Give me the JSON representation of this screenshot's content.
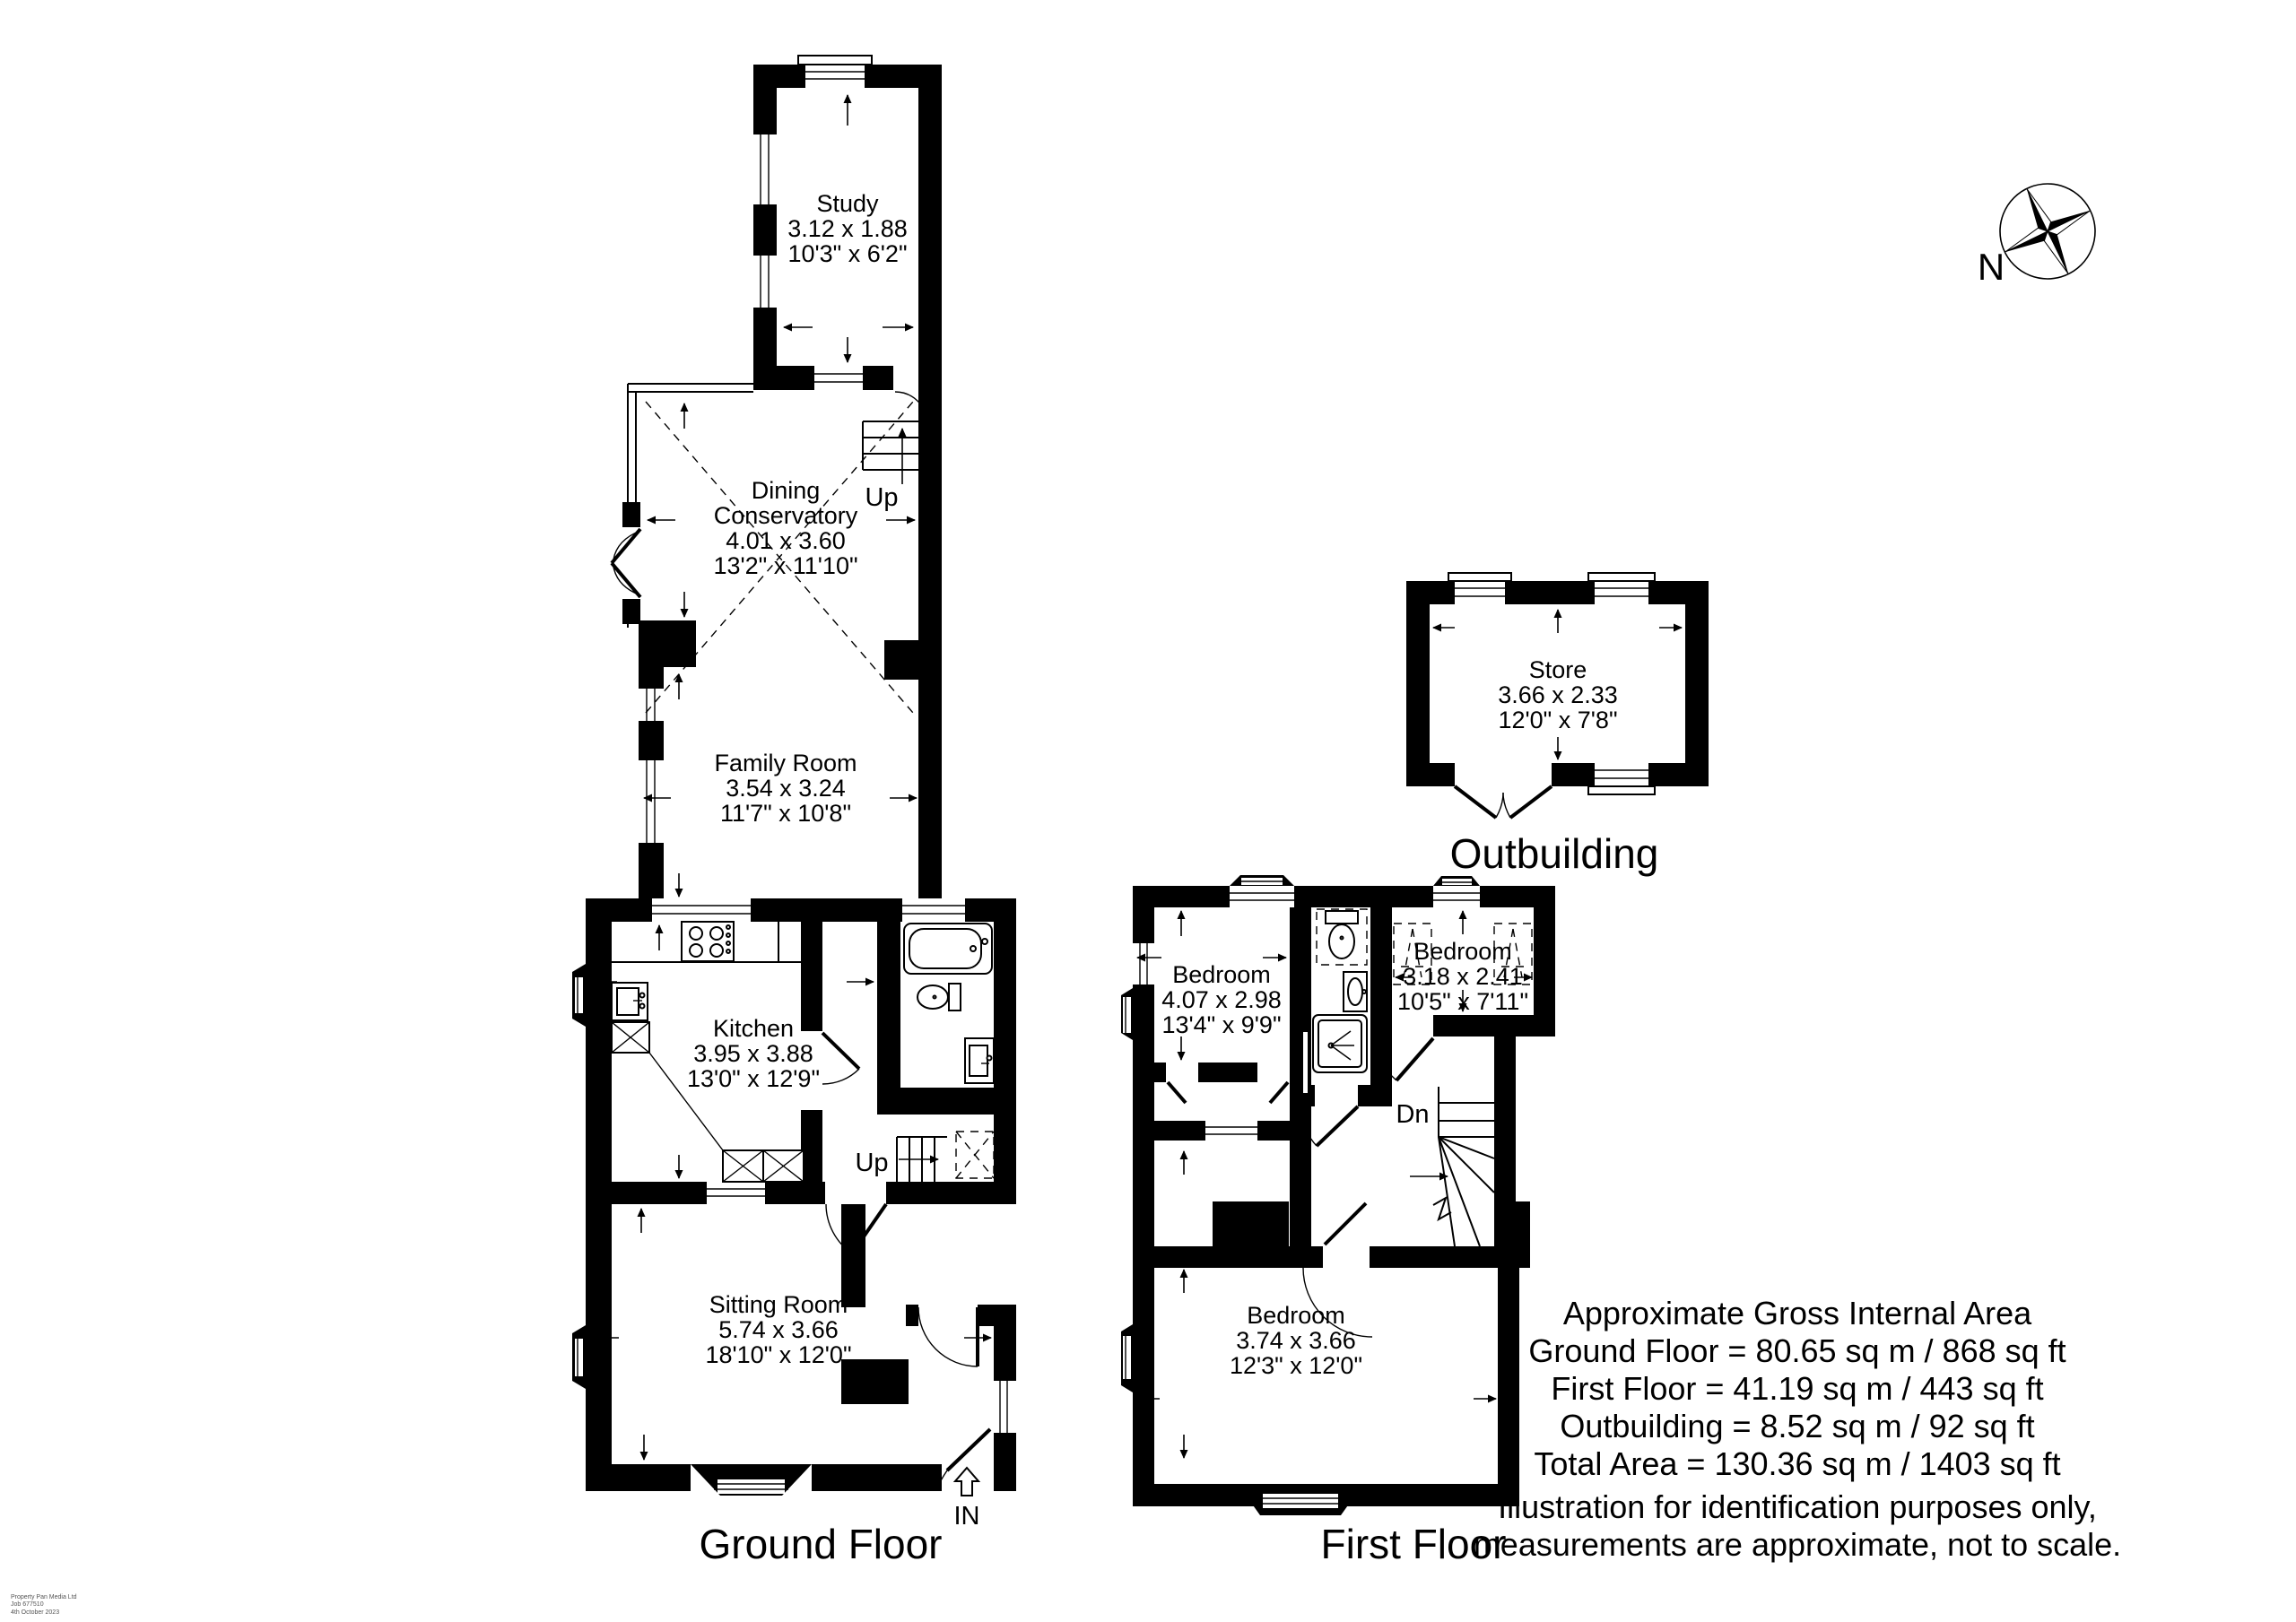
{
  "ground_floor": {
    "title": "Ground Floor",
    "study": {
      "name": "Study",
      "metric": "3.12 x 1.88",
      "imperial": "10'3\" x 6'2\""
    },
    "dining_conservatory": {
      "name_line1": "Dining",
      "name_line2": "Conservatory",
      "metric": "4.01 x 3.60",
      "imperial": "13'2\" x 11'10\""
    },
    "family_room": {
      "name": "Family Room",
      "metric": "3.54 x 3.24",
      "imperial": "11'7\" x 10'8\""
    },
    "kitchen": {
      "name": "Kitchen",
      "metric": "3.95 x 3.88",
      "imperial": "13'0\" x 12'9\""
    },
    "sitting_room": {
      "name": "Sitting Room",
      "metric": "5.74 x 3.66",
      "imperial": "18'10\" x 12'0\""
    },
    "stairs_up_label": "Up",
    "hall_stairs_up_label": "Up",
    "entrance_label": "IN"
  },
  "first_floor": {
    "title": "First Floor",
    "bedroom_1": {
      "name": "Bedroom",
      "metric": "4.07 x 2.98",
      "imperial": "13'4\" x 9'9\""
    },
    "bedroom_2": {
      "name": "Bedroom",
      "metric": "3.18 x 2.41",
      "imperial": "10'5\" x 7'11\""
    },
    "bedroom_3": {
      "name": "Bedroom",
      "metric": "3.74 x 3.66",
      "imperial": "12'3\" x 12'0\""
    },
    "stairs_down_label": "Dn"
  },
  "outbuilding": {
    "title": "Outbuilding",
    "store": {
      "name": "Store",
      "metric": "3.66 x 2.33",
      "imperial": "12'0\" x 7'8\""
    }
  },
  "compass": {
    "north_label": "N"
  },
  "area_summary": {
    "line1": "Approximate Gross Internal Area",
    "line2": "Ground Floor = 80.65 sq m / 868 sq ft",
    "line3": "First Floor = 41.19 sq m / 443 sq ft",
    "line4": "Outbuilding = 8.52 sq m / 92 sq ft",
    "line5": "Total Area = 130.36 sq m / 1403 sq ft",
    "line6": "Illustration for identification purposes only,",
    "line7": "measurements are approximate, not to scale."
  },
  "credit": {
    "line1": "Property Pan Media Ltd",
    "line2": "Job 677510",
    "line3": "4th October 2023"
  },
  "colors": {
    "wall": "#000000",
    "background": "#ffffff"
  }
}
